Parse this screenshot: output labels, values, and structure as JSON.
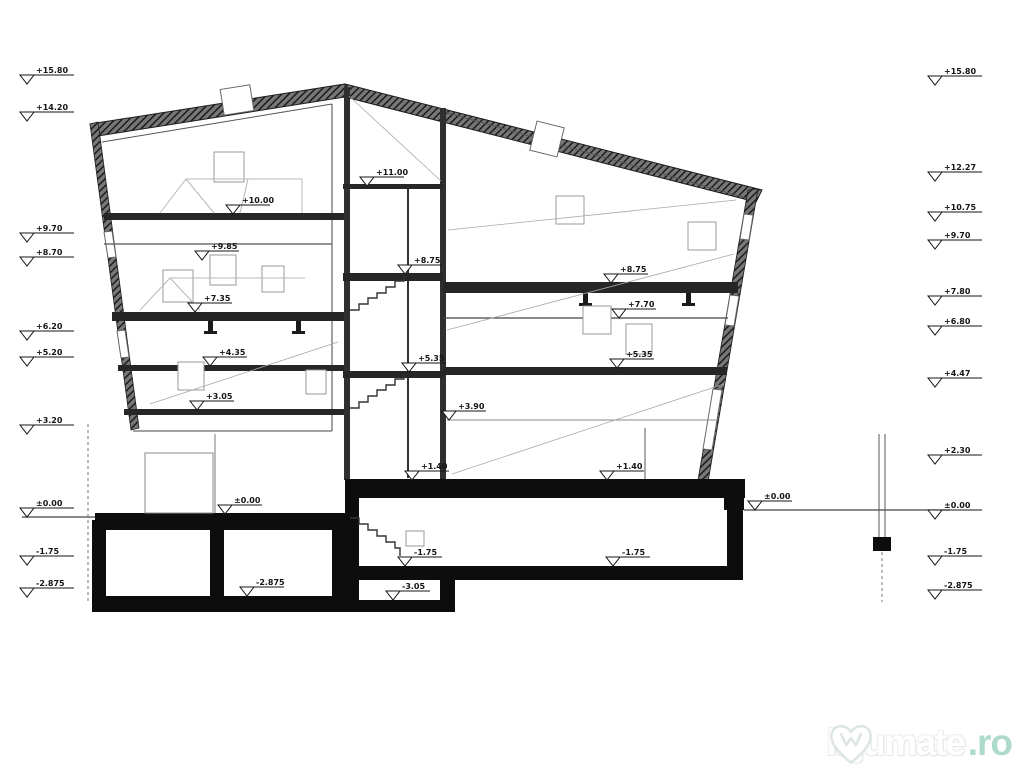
{
  "watermark": {
    "text": "lajumate",
    "tld": ".ro",
    "accent": "#aedacd",
    "outline": "#dde6e2"
  },
  "colors": {
    "ink": "#151515",
    "paper": "#ffffff",
    "roof": "#3a3a3a",
    "slab": "#262626",
    "foundation": "#0d0d0d"
  },
  "markers": {
    "left_column": [
      {
        "x": 30,
        "y": 75,
        "label": "+15.80"
      },
      {
        "x": 30,
        "y": 112,
        "label": "+14.20"
      },
      {
        "x": 30,
        "y": 233,
        "label": "+9.70"
      },
      {
        "x": 30,
        "y": 257,
        "label": "+8.70"
      },
      {
        "x": 30,
        "y": 331,
        "label": "+6.20"
      },
      {
        "x": 30,
        "y": 357,
        "label": "+5.20"
      },
      {
        "x": 30,
        "y": 425,
        "label": "+3.20"
      },
      {
        "x": 30,
        "y": 508,
        "label": "±0.00"
      },
      {
        "x": 30,
        "y": 556,
        "label": "-1.75"
      },
      {
        "x": 30,
        "y": 588,
        "label": "-2.875"
      }
    ],
    "right_column": [
      {
        "x": 938,
        "y": 76,
        "label": "+15.80"
      },
      {
        "x": 938,
        "y": 172,
        "label": "+12.27"
      },
      {
        "x": 938,
        "y": 212,
        "label": "+10.75"
      },
      {
        "x": 938,
        "y": 240,
        "label": "+9.70"
      },
      {
        "x": 938,
        "y": 296,
        "label": "+7.80"
      },
      {
        "x": 938,
        "y": 326,
        "label": "+6.80"
      },
      {
        "x": 938,
        "y": 378,
        "label": "+4.47"
      },
      {
        "x": 938,
        "y": 455,
        "label": "+2.30"
      },
      {
        "x": 938,
        "y": 510,
        "label": "±0.00"
      },
      {
        "x": 938,
        "y": 556,
        "label": "-1.75"
      },
      {
        "x": 938,
        "y": 590,
        "label": "-2.875"
      }
    ],
    "interior": [
      {
        "x": 370,
        "y": 177,
        "label": "+11.00"
      },
      {
        "x": 236,
        "y": 205,
        "label": "+10.00"
      },
      {
        "x": 205,
        "y": 251,
        "label": "+9.85"
      },
      {
        "x": 198,
        "y": 303,
        "label": "+7.35"
      },
      {
        "x": 213,
        "y": 357,
        "label": "+4.35"
      },
      {
        "x": 200,
        "y": 401,
        "label": "+3.05"
      },
      {
        "x": 228,
        "y": 505,
        "label": "±0.00"
      },
      {
        "x": 250,
        "y": 587,
        "label": "-2.875"
      },
      {
        "x": 408,
        "y": 265,
        "label": "+8.75"
      },
      {
        "x": 412,
        "y": 363,
        "label": "+5.35"
      },
      {
        "x": 415,
        "y": 471,
        "label": "+1.40"
      },
      {
        "x": 610,
        "y": 471,
        "label": "+1.40"
      },
      {
        "x": 614,
        "y": 274,
        "label": "+8.75"
      },
      {
        "x": 622,
        "y": 309,
        "label": "+7.70"
      },
      {
        "x": 620,
        "y": 359,
        "label": "+5.35"
      },
      {
        "x": 452,
        "y": 411,
        "label": "+3.90"
      },
      {
        "x": 408,
        "y": 557,
        "label": "-1.75"
      },
      {
        "x": 616,
        "y": 557,
        "label": "-1.75"
      },
      {
        "x": 396,
        "y": 591,
        "label": "-3.05"
      },
      {
        "x": 758,
        "y": 501,
        "label": "±0.00"
      }
    ]
  }
}
